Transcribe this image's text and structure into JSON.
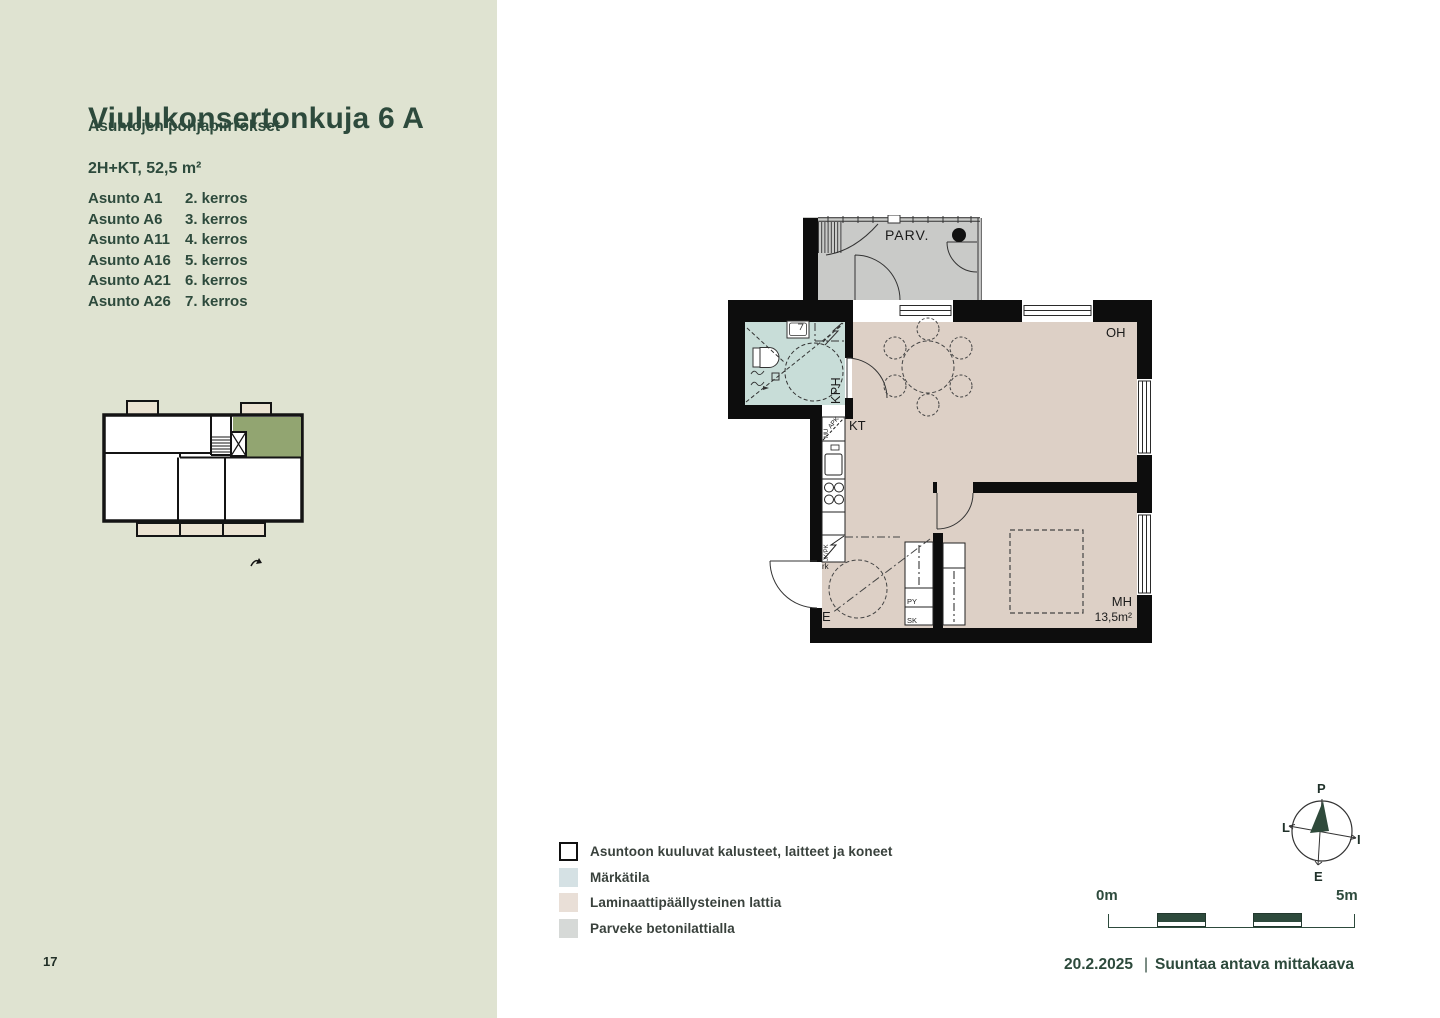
{
  "page": {
    "number": "17"
  },
  "sidebar": {
    "title": "Viulukonsertonkuja 6 A",
    "subtitle": "Asuntojen pohjapiirrokset",
    "apartment_type": "2H+KT, 52,5 m²",
    "apartments": [
      {
        "name": "Asunto A1",
        "floor": "2. kerros"
      },
      {
        "name": "Asunto A6",
        "floor": "3. kerros"
      },
      {
        "name": "Asunto A11",
        "floor": "4. kerros"
      },
      {
        "name": "Asunto A16",
        "floor": "5. kerros"
      },
      {
        "name": "Asunto A21",
        "floor": "6. kerros"
      },
      {
        "name": "Asunto A26",
        "floor": "7. kerros"
      }
    ]
  },
  "floorplan": {
    "labels": {
      "balcony": "PARV.",
      "bathroom": "KPH",
      "kitchen": "KT",
      "living_room": "OH",
      "bedroom": "MH",
      "bedroom_area": "13,5m²",
      "entrance": "E",
      "dishwasher": "APK",
      "microwave": "MU",
      "fridge_freezer": "JK/PK",
      "cabinet": "rk",
      "laundry_closet": "PY",
      "cleaning_closet": "SK"
    }
  },
  "legend": {
    "items": [
      {
        "label": "Asuntoon kuuluvat kalusteet, laitteet ja koneet",
        "swatch": "#ffffff"
      },
      {
        "label": "Märkätila",
        "swatch": "#d5e1e4"
      },
      {
        "label": "Laminaattipäällysteinen lattia",
        "swatch": "#e9dfd7"
      },
      {
        "label": "Parveke betonilattialla",
        "swatch": "#d6d9d7"
      }
    ]
  },
  "scalebar": {
    "start_label": "0m",
    "end_label": "5m"
  },
  "compass": {
    "north": "P",
    "east": "I",
    "south": "E",
    "west": "L"
  },
  "footer": {
    "date": "20.2.2025",
    "separator": "|",
    "note": "Suuntaa antava mittakaava"
  },
  "colors": {
    "sidebar_bg": "#dfe3d1",
    "text_green": "#2d4a3c",
    "laminate_floor": "#ddd0c6",
    "wet_room_floor": "#c8ddd8",
    "balcony_concrete": "#c9cac8",
    "keyplan_highlight": "#92a571",
    "keyplan_balcony": "#ebe3d2",
    "wall": "#0d0d0d"
  }
}
